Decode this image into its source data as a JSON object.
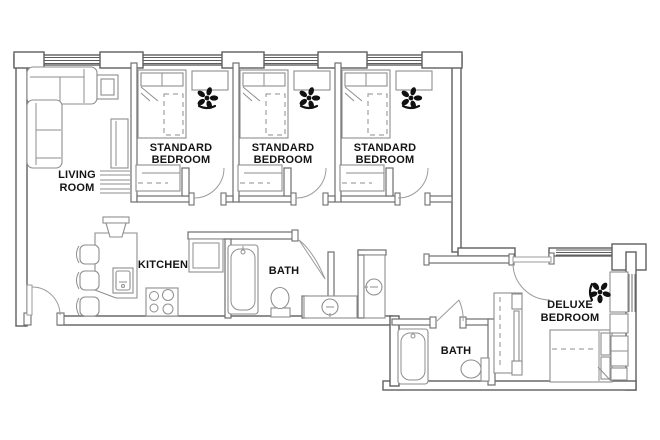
{
  "plan": {
    "rooms": {
      "living_room": {
        "line1": "LIVING",
        "line2": "ROOM"
      },
      "standard_bedroom_1": {
        "line1": "STANDARD",
        "line2": "BEDROOM"
      },
      "standard_bedroom_2": {
        "line1": "STANDARD",
        "line2": "BEDROOM"
      },
      "standard_bedroom_3": {
        "line1": "STANDARD",
        "line2": "BEDROOM"
      },
      "kitchen": {
        "line1": "KITCHEN"
      },
      "bath_1": {
        "line1": "BATH"
      },
      "bath_2": {
        "line1": "BATH"
      },
      "deluxe_bedroom": {
        "line1": "DELUXE",
        "line2": "BEDROOM"
      }
    },
    "colors": {
      "background": "#ffffff",
      "wall_line": "#5f5f5f",
      "interior_line": "#6f6f6f",
      "fixture_line": "#8e8e8e",
      "door_line": "#9b9b9b",
      "label_text": "#141414",
      "chair_fill": "#111111"
    }
  }
}
